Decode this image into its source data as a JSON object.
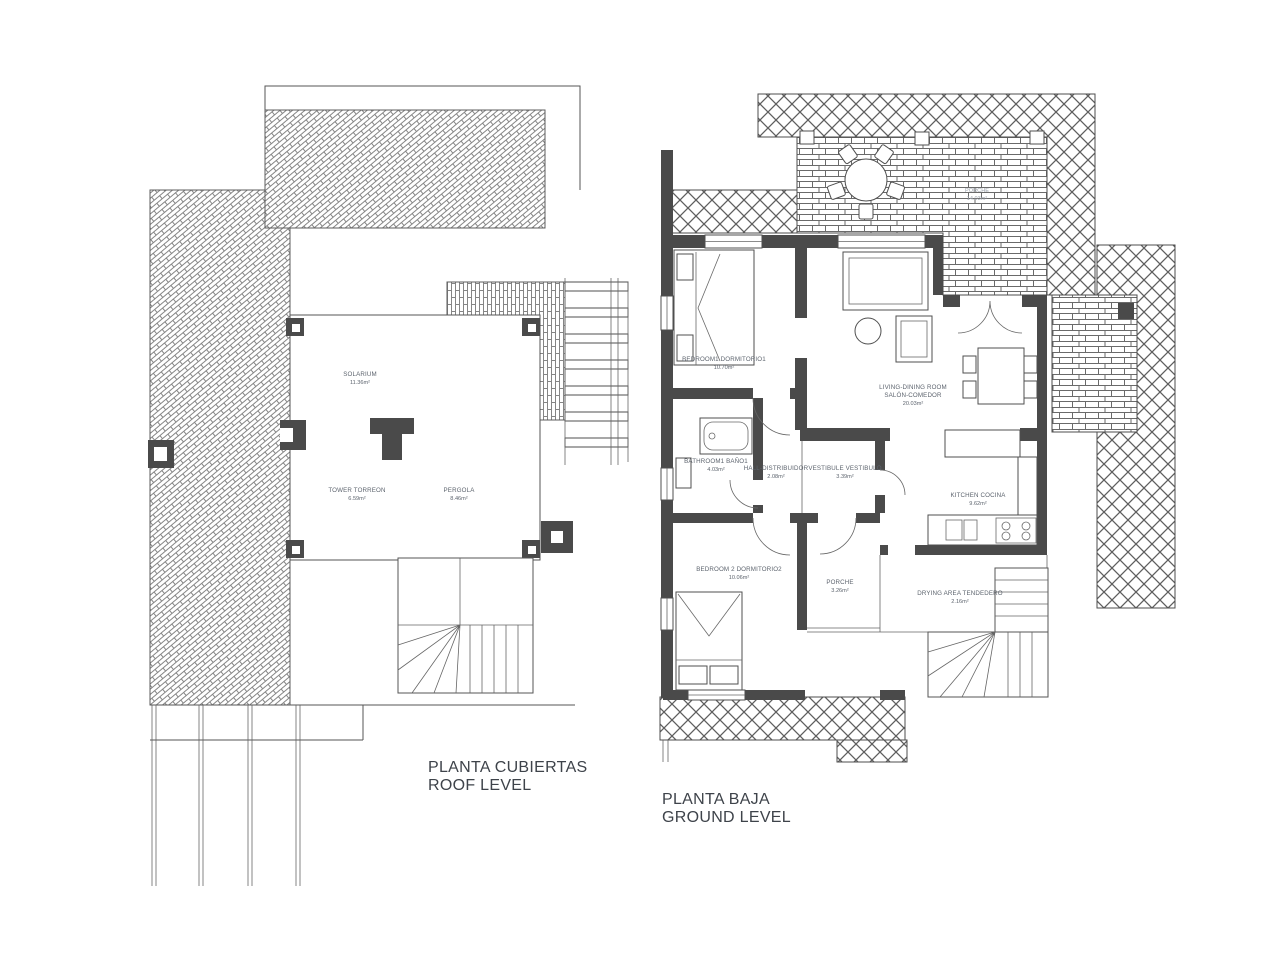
{
  "colors": {
    "background": "#ffffff",
    "wall": "#4a4a4a",
    "line": "#555555",
    "hatch_stroke": "#808080",
    "brick_stroke": "#6a6a6a",
    "crosshatch_stroke": "#5f5f5f",
    "label_text": "#5d646e",
    "faint_label_text": "#9aa1ab",
    "title_text": "#3e434a"
  },
  "plans": {
    "roof": {
      "title_line1": "PLANTA CUBIERTAS",
      "title_line2": "ROOF LEVEL",
      "rooms": [
        {
          "id": "solarium",
          "name": "SOLARIUM",
          "area": "11.36m²"
        },
        {
          "id": "tower",
          "name": "TOWER TORREON",
          "area": "6.59m²"
        },
        {
          "id": "pergola",
          "name": "PERGOLA",
          "area": "8.46m²"
        }
      ]
    },
    "ground": {
      "title_line1": "PLANTA BAJA",
      "title_line2": "GROUND LEVEL",
      "rooms": [
        {
          "id": "terrace",
          "name": "PORCHE",
          "area": "14.03m²"
        },
        {
          "id": "bedroom1",
          "name": "BEDROOM1 DORMITORIO1",
          "area": "10.70m²"
        },
        {
          "id": "living",
          "name": "LIVING-DINING ROOM",
          "name2": "SALÓN-COMEDOR",
          "area": "20.03m²"
        },
        {
          "id": "bathroom1",
          "name": "BATHROOM1 BAÑO1",
          "area": "4.03m²"
        },
        {
          "id": "hall",
          "name": "HALL-DISTRIBUIDOR",
          "area": "2.08m²"
        },
        {
          "id": "vestibule",
          "name": "VESTIBULE VESTIBULO",
          "area": "3.39m²"
        },
        {
          "id": "kitchen",
          "name": "KITCHEN COCINA",
          "area": "9.62m²"
        },
        {
          "id": "bedroom2",
          "name": "BEDROOM 2 DORMITORIO2",
          "area": "10.06m²"
        },
        {
          "id": "porche",
          "name": "PORCHE",
          "area": "3.26m²"
        },
        {
          "id": "drying",
          "name": "DRYING AREA TENDEDERO",
          "area": "2.16m²"
        }
      ]
    }
  }
}
